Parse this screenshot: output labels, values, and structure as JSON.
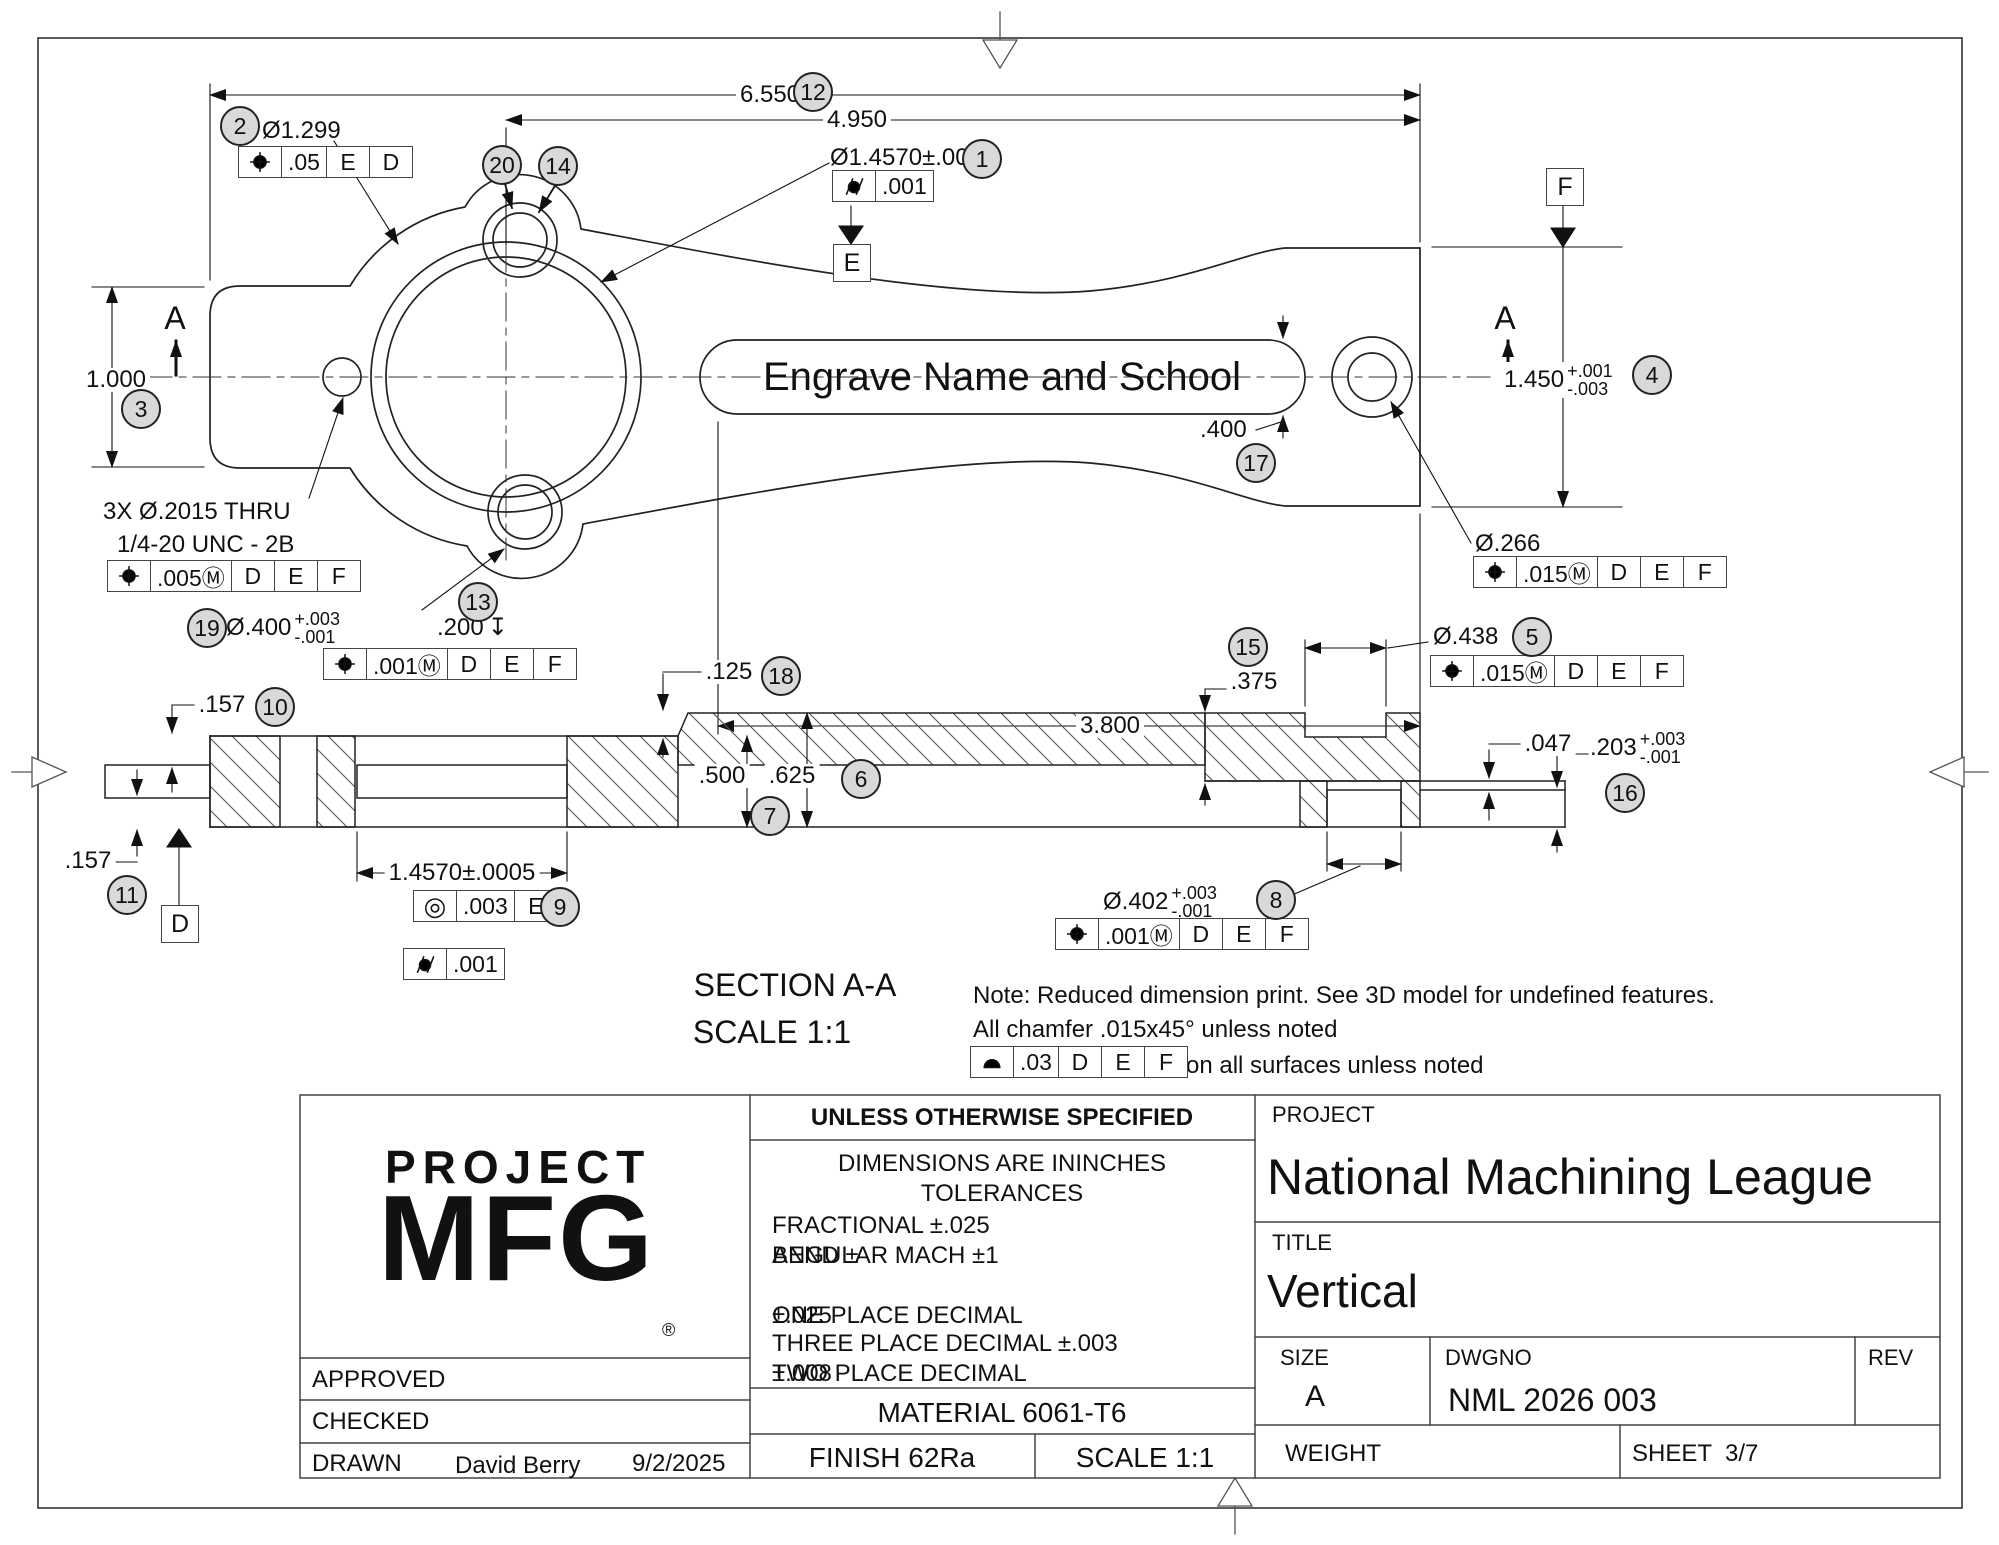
{
  "plan": {
    "dim_6550": "6.550",
    "dim_4950": "4.950",
    "dim_1000": "1.000",
    "dia_1299": "Ø1.299",
    "fcf_1299": {
      "sym": "position",
      "tol": ".05",
      "d1": "E",
      "d2": "D"
    },
    "dia_1457": "Ø1.4570±.0005",
    "fcf_1457": {
      "sym": "cylindricity",
      "tol": ".001"
    },
    "datum_e": "E",
    "datum_f": "F",
    "section_letter": "A",
    "thread_note_1": "3X Ø.2015 THRU",
    "thread_note_2": "1/4-20 UNC - 2B",
    "fcf_2015": {
      "sym": "position",
      "tol": ".005Ⓜ",
      "d1": "D",
      "d2": "E",
      "d3": "F"
    },
    "hole400_note": "2X Ø.400",
    "hole400_p": "+.003",
    "hole400_m": "-.001",
    "depth200": ".200",
    "depth_sym": "↧",
    "fcf_400": {
      "sym": "position",
      "tol": ".001Ⓜ",
      "d1": "D",
      "d2": "E",
      "d3": "F"
    },
    "slot_text": "Engrave Name and School",
    "dim_400": ".400",
    "dim_3800": "3.800",
    "dim_1450": "1.450",
    "dim_1450_p": "+.001",
    "dim_1450_m": "-.003",
    "dia_266": "Ø.266",
    "fcf_266": {
      "sym": "position",
      "tol": ".015Ⓜ",
      "d1": "D",
      "d2": "E",
      "d3": "F"
    },
    "dia_438": "Ø.438",
    "fcf_438": {
      "sym": "position",
      "tol": ".015Ⓜ",
      "d1": "D",
      "d2": "E",
      "d3": "F"
    }
  },
  "section": {
    "dim_157_top": ".157",
    "dim_157_bot": ".157",
    "dim_125": ".125",
    "dim_500": ".500",
    "dim_625": ".625",
    "dim_375": ".375",
    "dim_047": ".047",
    "dim_203": ".203",
    "dim_203_p": "+.003",
    "dim_203_m": "-.001",
    "dim_1457": "1.4570±.0005",
    "fcf_conc": {
      "sym": "concentricity",
      "tol": ".003",
      "d1": "E"
    },
    "fcf_cyl": {
      "sym": "cylindricity",
      "tol": ".001"
    },
    "dia_402": "Ø.402",
    "dia_402_p": "+.003",
    "dia_402_m": "-.001",
    "fcf_402": {
      "sym": "position",
      "tol": ".001Ⓜ",
      "d1": "D",
      "d2": "E",
      "d3": "F"
    },
    "title": "SECTION A-A",
    "scale": "SCALE 1:1",
    "datum_d": "D"
  },
  "notes": {
    "line1": "Note: Reduced dimension print. See 3D model for undefined features.",
    "line2": "All chamfer .015x45° unless noted",
    "fcf_profile": {
      "sym": "profile",
      "tol": ".03",
      "d1": "D",
      "d2": "E",
      "d3": "F"
    },
    "line3_suffix": "on all surfaces unless noted"
  },
  "titleblock": {
    "logo1": "PROJECT",
    "logo2": "MFG",
    "logo_r": "®",
    "uos": "UNLESS OTHERWISE SPECIFIED",
    "dims_line": "DIMENSIONS ARE ININCHES",
    "tol_header": "TOLERANCES",
    "frac": "FRACTIONAL ±.025",
    "angular": "ANGULAR MACH ±1",
    "bend": "BEND ±",
    "one_place": "ONE PLACE DECIMAL",
    "one_tol": "±.025",
    "two_place": "TWO PLACE DECIMAL",
    "two_tol": "±.008",
    "three_place": "THREE PLACE DECIMAL ±.003",
    "approved": "APPROVED",
    "checked": "CHECKED",
    "drawn": "DRAWN",
    "drawn_by": "David Berry",
    "drawn_date": "9/2/2025",
    "material": "MATERIAL 6061-T6",
    "finish": "FINISH 62Ra",
    "scale": "SCALE 1:1",
    "project_label": "PROJECT",
    "project": "National Machining League",
    "title_label": "TITLE",
    "title": "Vertical",
    "size_label": "SIZE",
    "size": "A",
    "dwgno_label": "DWGNO",
    "dwgno": "NML 2026 003",
    "rev_label": "REV",
    "weight_label": "WEIGHT",
    "sheet_label": "SHEET",
    "sheet": "3/7"
  },
  "balloons": {
    "b1": "1",
    "b2": "2",
    "b3": "3",
    "b4": "4",
    "b5": "5",
    "b6": "6",
    "b7": "7",
    "b8": "8",
    "b9": "9",
    "b10": "10",
    "b11": "11",
    "b12": "12",
    "b13": "13",
    "b14": "14",
    "b15": "15",
    "b16": "16",
    "b17": "17",
    "b18": "18",
    "b19": "19",
    "b20": "20"
  }
}
